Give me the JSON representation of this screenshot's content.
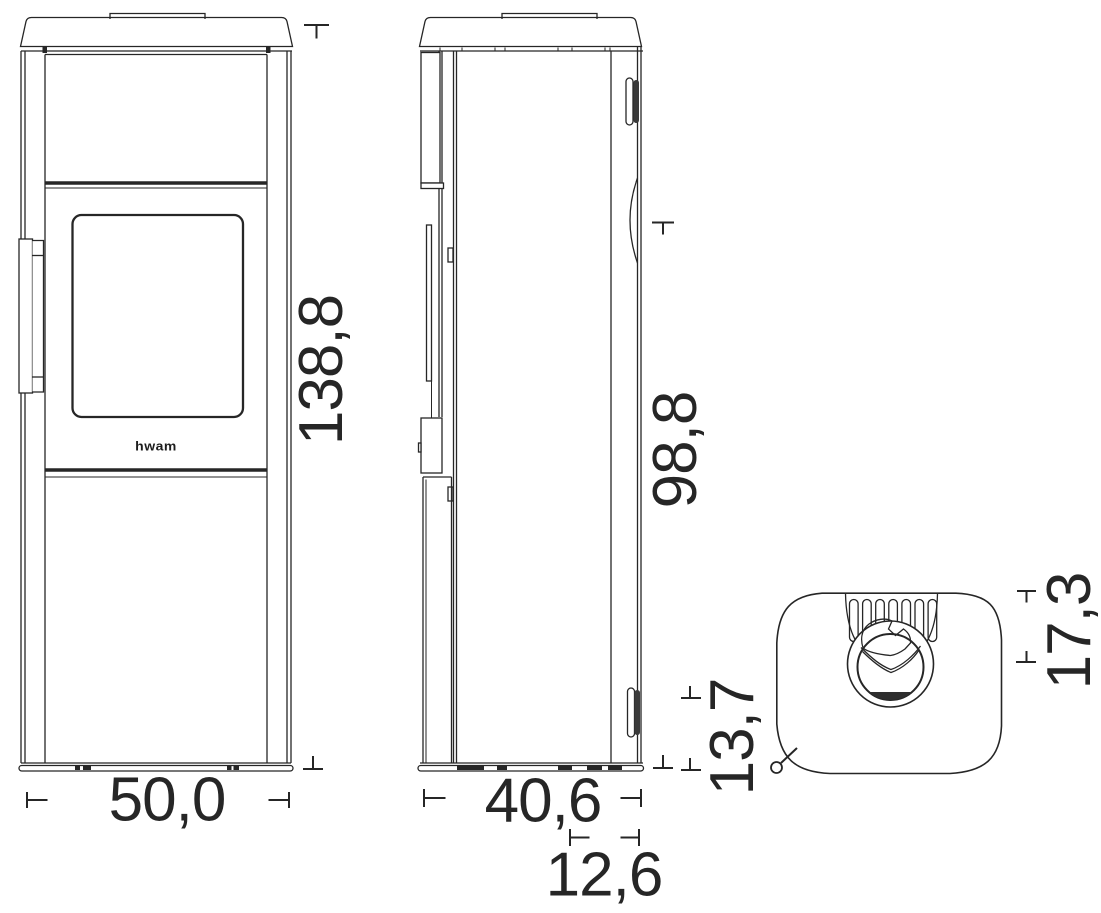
{
  "drawing": {
    "background": "#ffffff",
    "line_color": "#262626",
    "logo_text": "hwam",
    "units_style": "decimal-comma",
    "views": {
      "front": {
        "height": "138,8",
        "width": "50,0"
      },
      "side": {
        "height": "98,8",
        "depth": "40,6",
        "plinth_height": "13,7",
        "flue_offset": "12,6"
      },
      "top": {
        "flue_to_side": "17,3"
      }
    }
  }
}
